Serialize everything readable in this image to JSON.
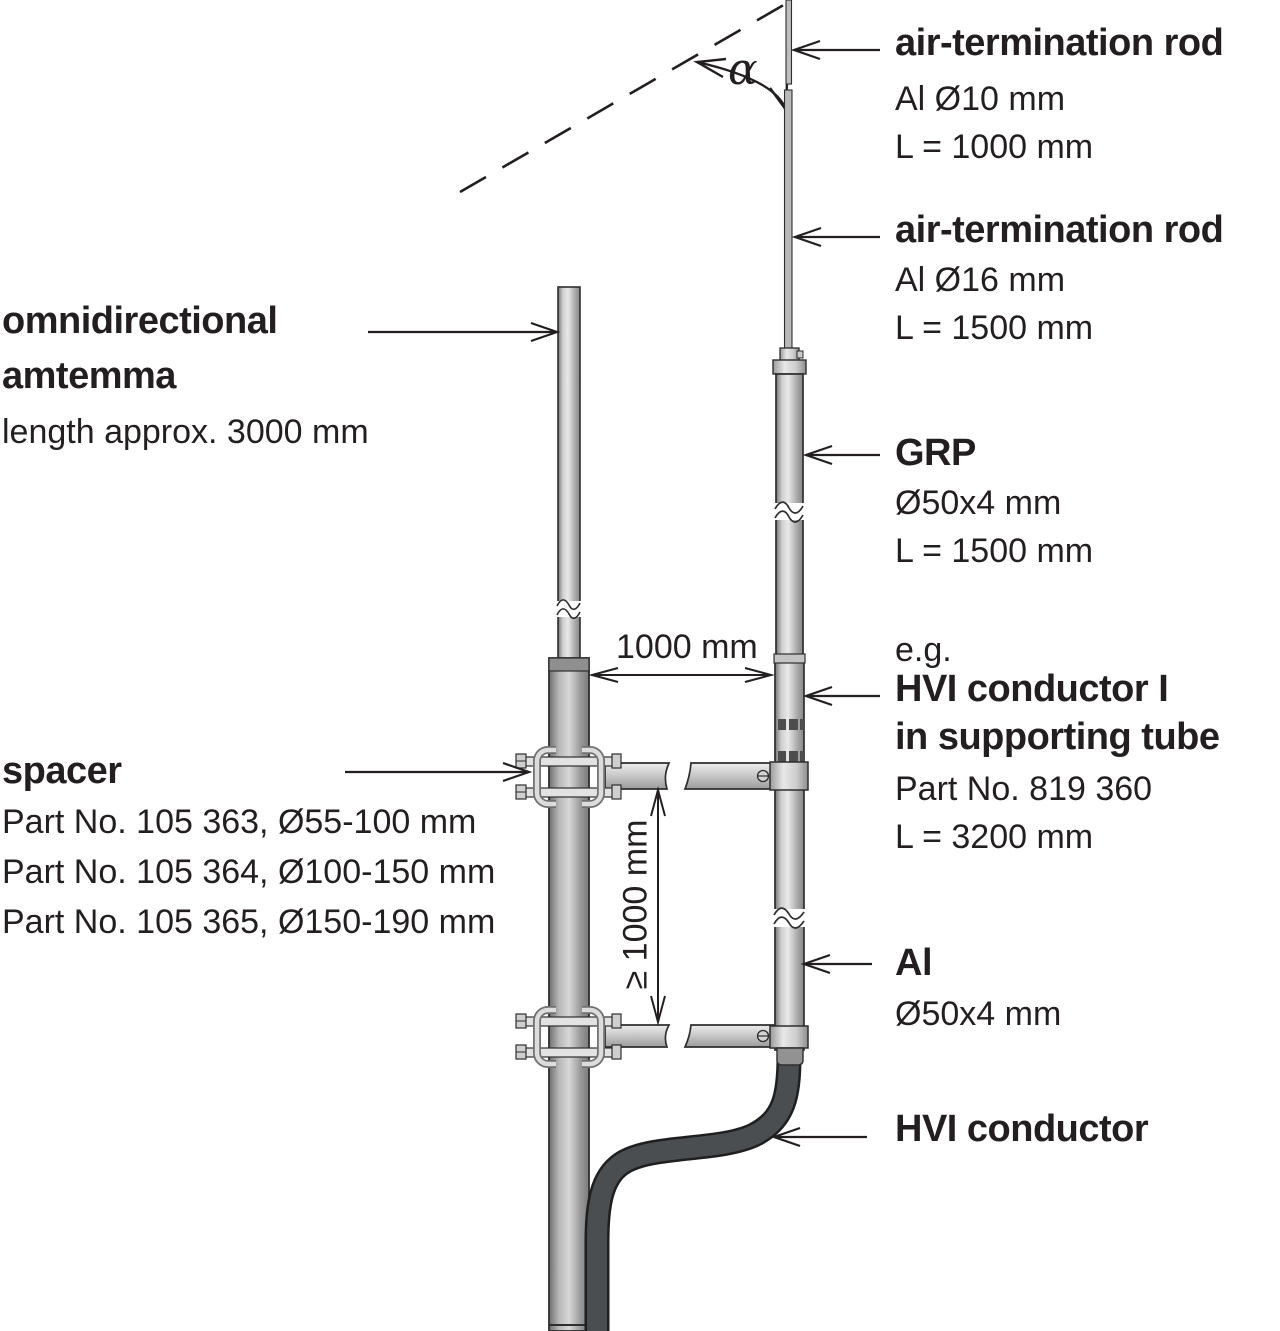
{
  "diagram": {
    "angle_symbol": "α",
    "dim_horizontal": "1000 mm",
    "dim_vertical": "≥ 1000 mm"
  },
  "labels": {
    "air_rod_thin": {
      "title": "air-termination rod",
      "spec1": "Al Ø10 mm",
      "spec2": "L = 1000 mm"
    },
    "air_rod_thick": {
      "title": "air-termination rod",
      "spec1": "Al Ø16 mm",
      "spec2": "L = 1500 mm"
    },
    "grp": {
      "title": "GRP",
      "spec1": "Ø50x4 mm",
      "spec2": "L = 1500 mm"
    },
    "hvi_supporting": {
      "prefix": "e.g.",
      "title_line1": "HVI conductor I",
      "title_line2": "in supporting tube",
      "spec1": "Part No. 819 360",
      "spec2": "L = 3200 mm"
    },
    "al_tube": {
      "title": "Al",
      "spec1": "Ø50x4 mm"
    },
    "hvi_conductor": {
      "title": "HVI conductor"
    },
    "antenna": {
      "title_line1": "omnidirectional",
      "title_line2": "amtemma",
      "spec1": "length approx. 3000 mm"
    },
    "spacer": {
      "title": "spacer",
      "spec1": "Part No. 105 363, Ø55-100 mm",
      "spec2": "Part No. 105 364, Ø100-150 mm",
      "spec3": "Part No. 105 365, Ø150-190 mm"
    }
  },
  "colors": {
    "ink": "#231f20",
    "tube_light": "#e6e6e6",
    "tube_dark": "#7a7a7a",
    "cable": "#4a4e50",
    "background": "#ffffff"
  }
}
